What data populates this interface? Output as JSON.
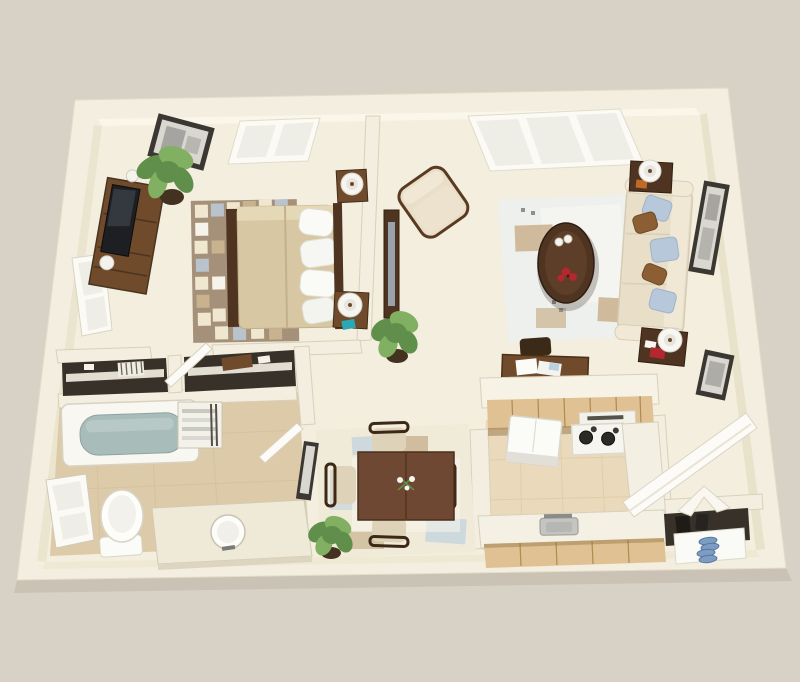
{
  "scene": {
    "label": "3D rendered floor plan of a one-bedroom apartment viewed from above"
  },
  "palette": {
    "bg": "#d8d2c6",
    "wallTop": "#f3eedf",
    "wallEdge": "#cfc7af",
    "wallFaceLight": "#faf6e9",
    "wallFaceShade": "#e9e2cb",
    "floor": "#f3eedd",
    "floorShade": "#e4ddc6",
    "tile": "#ddcaa8",
    "tileLight": "#ead9ba",
    "closetDark": "#37312a",
    "woodDark": "#4e3421",
    "woodMid": "#6f4b2c",
    "tableWood": "#6e4833",
    "chairWood": "#3c2817",
    "maple": "#dfc193",
    "mapleShadow": "#8a6b3c",
    "cream": "#e9dfc8",
    "bedTan": "#d8c7a3",
    "pillowBlue": "#b7c8da",
    "pillowBrown": "#8c5e33",
    "water": "#a8bcba",
    "plant1": "#5f8f4a",
    "plant2": "#82b063",
    "potDark": "#43321f",
    "frame": "#3b3733",
    "art": "#d9d7d0",
    "artInk": "#8f8f8b",
    "red": "#b3272e",
    "teal": "#2ba7b5",
    "shoeBlue": "#7d9cc2",
    "rugTaupe": "#a5917a",
    "rugCream": "#efe7cf",
    "rugWhite": "#f6f3ea",
    "rugBlue": "#b9c3cb",
    "rugTan": "#c9b28e",
    "lrRug": "#edf0ec",
    "dinRug": "#f0ead9",
    "white": "#fbfaf5",
    "glass": "#efeee6",
    "steel": "#c4c4c0",
    "burner": "#2b2a27",
    "cushion": "#ded2b8"
  },
  "rooms": {
    "bedroom": {
      "items": [
        "framed-art",
        "top-window",
        "side-window",
        "potted-plant",
        "dresser",
        "tv",
        "checkered-area-rug",
        "double-bed",
        "nightstand-with-lamp-top",
        "nightstand-with-lamp-bottom",
        "teal-box"
      ]
    },
    "living_room": {
      "items": [
        "top-window",
        "armchair",
        "area-rug",
        "oval-coffee-table",
        "red-flowers",
        "white-cups",
        "sofa",
        "throw-pillows",
        "end-table-with-lamp-top",
        "end-table-with-lamp-bottom",
        "framed-art-upper",
        "framed-art-lower",
        "console-table",
        "potted-plant",
        "desk-with-papers",
        "desk-chair"
      ]
    },
    "bathroom": {
      "items": [
        "bathtub",
        "window",
        "toilet",
        "vanity-with-round-sink",
        "towel-shelf"
      ]
    },
    "closets": {
      "items": [
        "closet-shelf-a",
        "closet-shelf-b",
        "storage-box",
        "slatted-item"
      ]
    },
    "dining_area": {
      "items": [
        "dining-table",
        "flower-centerpiece",
        "dining-chair-north",
        "dining-chair-south",
        "dining-chair-west",
        "dining-chair-east",
        "area-rug",
        "potted-plant",
        "framed-art"
      ]
    },
    "kitchen": {
      "items": [
        "pass-through-bar",
        "upper-cabinets",
        "refrigerator",
        "range-with-burners",
        "vent-hood",
        "right-counter",
        "sink-counter",
        "steel-sink",
        "lower-cabinets"
      ]
    },
    "entry": {
      "items": [
        "front-door",
        "bifold-closet-door",
        "coat-closet",
        "shoe-shelf",
        "blue-shoes"
      ]
    },
    "doors": {
      "items": [
        "bedroom-door",
        "bathroom-door"
      ]
    }
  }
}
